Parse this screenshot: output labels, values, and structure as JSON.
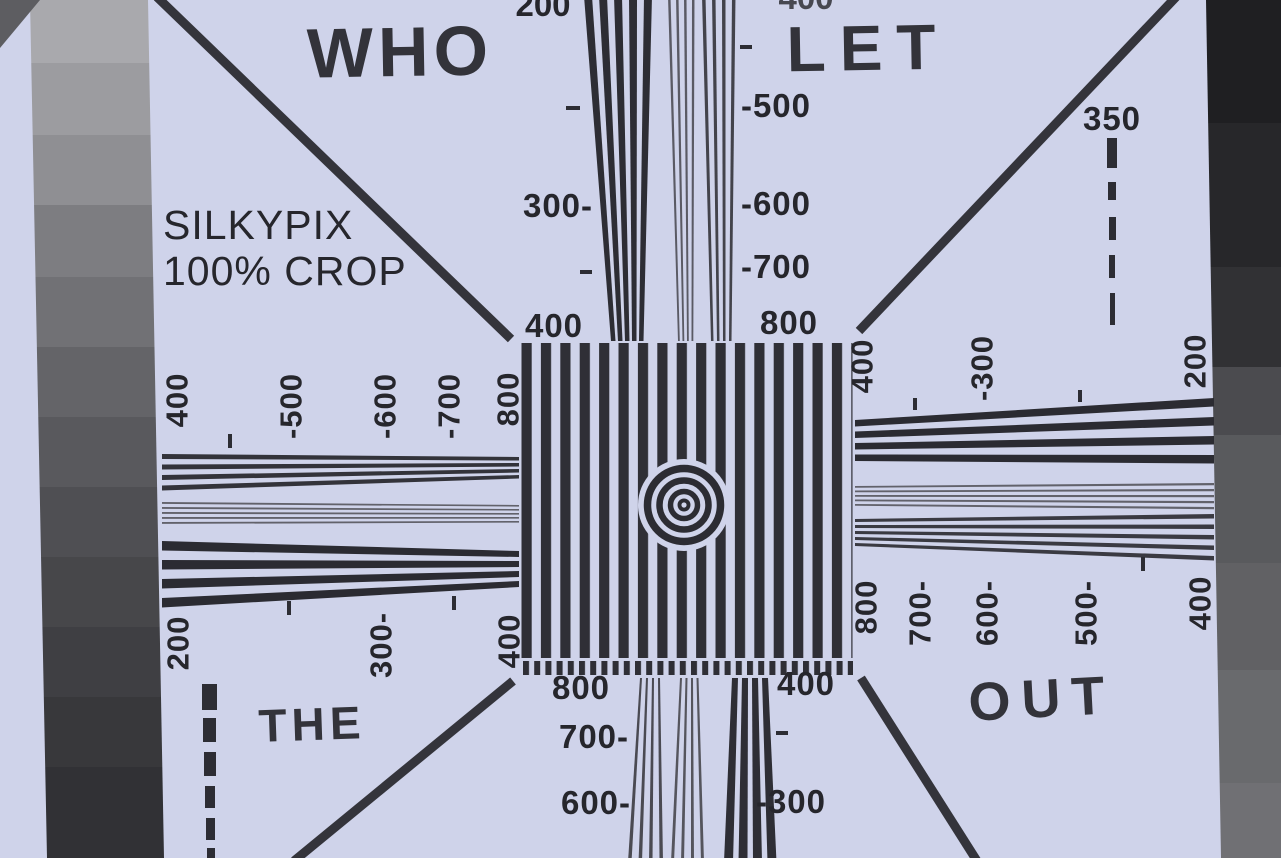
{
  "title_overlay": {
    "line1": "SILKYPIX",
    "line2": "100% CROP",
    "color": "#17171b"
  },
  "handwriting": {
    "top_left": "WHO",
    "top_right": "LET",
    "bottom_left": "THE",
    "bottom_right": "OUT",
    "ink_color": "#4c4caa"
  },
  "paper_color": "#cfd3ea",
  "ink_color": "#2b2b31",
  "scales": {
    "top_left_clipped": "200",
    "top_right_clipped": "400",
    "top_left": [
      "300-",
      "400"
    ],
    "top_right": [
      "-500",
      "-600",
      "-700",
      "800"
    ],
    "diag_top_right": "350",
    "left_top": [
      "400",
      "-500",
      "-600",
      "-700",
      "800"
    ],
    "left_bottom": [
      "200",
      "300-",
      "400"
    ],
    "right_top": [
      "400",
      "-300",
      "200"
    ],
    "right_bottom": [
      "800",
      "700-",
      "600-",
      "500-",
      "400"
    ],
    "bottom_left": [
      "800",
      "700-",
      "600-"
    ],
    "bottom_right": [
      "400",
      "-300"
    ]
  },
  "grayscale_left": [
    "#a9a9ad",
    "#9c9ca0",
    "#8f8f93",
    "#7d7d81",
    "#717175",
    "#646468",
    "#59595d",
    "#4f4f53",
    "#47474a",
    "#3f3f43",
    "#38383b",
    "#313135"
  ],
  "grayscale_right": [
    "#1f1f22",
    "#27272a",
    "#313134",
    "#4b4b4f",
    "#595a5d",
    "#616164",
    "#696a6d",
    "#707074"
  ]
}
